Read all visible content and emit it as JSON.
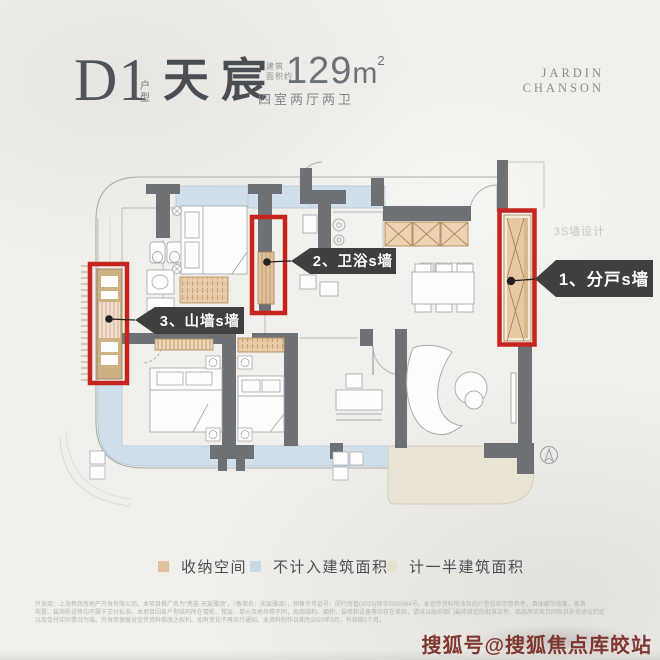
{
  "header": {
    "plan_code": "D1",
    "plan_code_suffix": "户型",
    "plan_name": "天宸",
    "area_prefix_line1": "建筑",
    "area_prefix_line2": "面积约",
    "area_value": "129",
    "area_unit": "m",
    "area_sup": "2",
    "layout_desc": "四室两厅两卫",
    "brand_line1": "JARDIN",
    "brand_line2": "CHANSON"
  },
  "floorplan": {
    "callouts": [
      {
        "label": "1、分戸s墙"
      },
      {
        "label": "2、卫浴s墙"
      },
      {
        "label": "3、山墙s墙"
      }
    ],
    "watermark_note": "· 3S墙设计"
  },
  "legend": {
    "items": [
      {
        "label": "收纳空间",
        "color": "#e2bf9d"
      },
      {
        "label": "不计入建筑面积",
        "color": "#c8dbe9"
      },
      {
        "label": "计一半建筑面积",
        "color": "#e7e2d0"
      }
    ]
  },
  "footer": {
    "disclaimer_lines": [
      "开发商：上海隽辉房地产开发有限公司。本项目推广名为“隽荟·天宸雅颂”，（备案名：天宸雅颂），预售许可证号：闵行房管(2023)预字0000064号。本宣传资料所涉及的户型仅供示意参考，具体细节效果、家具",
      "布置、装饰陈设等均不属于交付标准。本项目因各户型结构所在楼栋、楼层、单元及地块等不同，局部结构、面积、装修和设备等均存在差异，请详以政府部门最终核定的批准文件、商品房买卖合同及其补充协议约定",
      "以及交付实际情况为准。开发商保留对宣传资料修改之权利。如有变化不再另行通知。本资料制作日期为2023年5月，有效期1个月。"
    ],
    "watermark": "搜狐号@搜狐焦点库皎站"
  },
  "colors": {
    "accent_red": "#c7241e",
    "callout_bg": "#3f3f3f",
    "wall_gray": "#6d7175",
    "balcony_blue": "#cfdfec",
    "half_area_beige": "#e9e4d3",
    "storage_tan": "#e8cda8",
    "watermark_red": "#7a2b24"
  }
}
